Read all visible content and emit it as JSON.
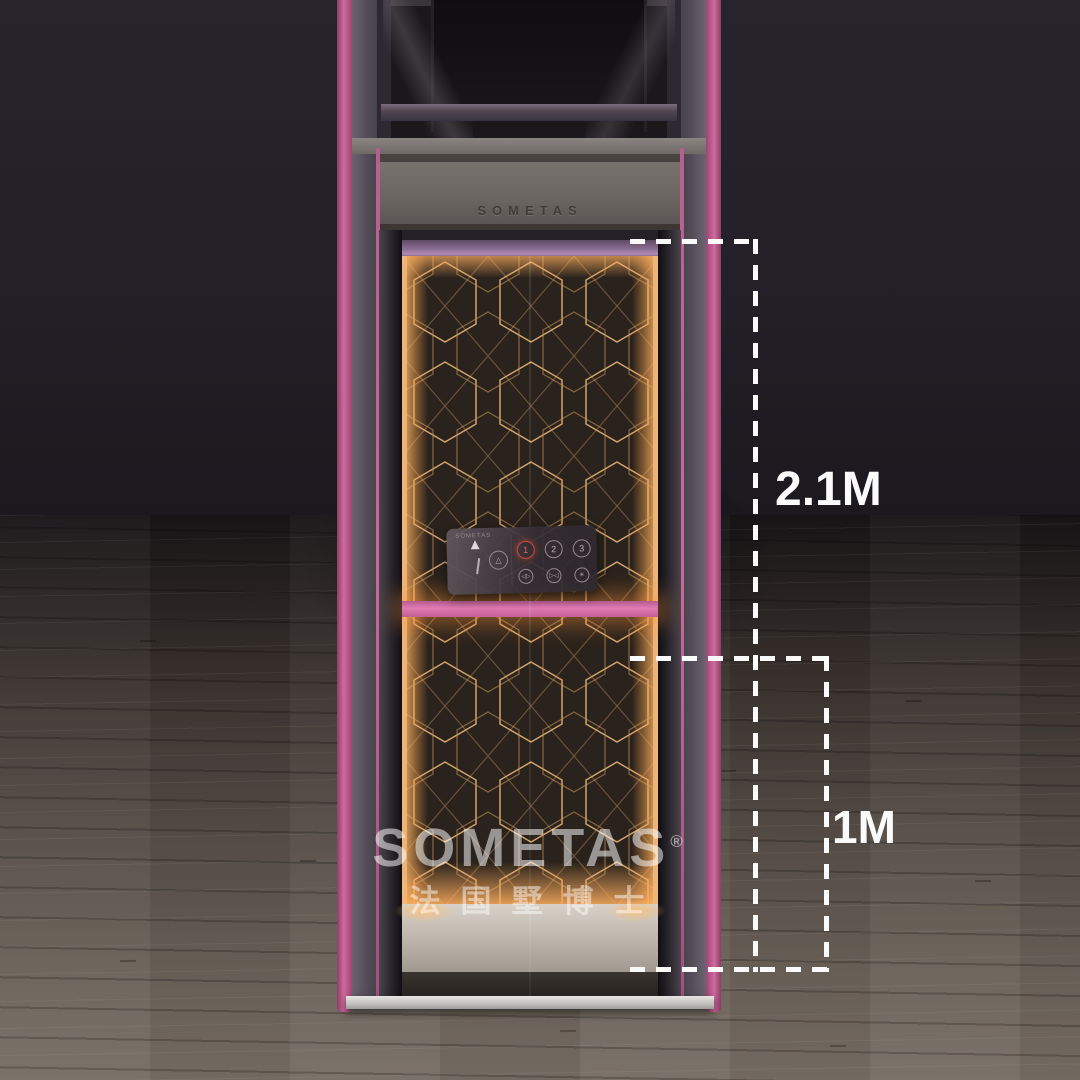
{
  "image": {
    "type": "product-render",
    "subject": "SOMETAS home villa elevator with dimension callouts"
  },
  "brand": {
    "name": "SOMETAS",
    "registered_mark": "®",
    "tagline_cn": "法国墅博士"
  },
  "header_plate": {
    "text": "SOMETAS"
  },
  "control_panel": {
    "logo": "SOMETAS",
    "direction_arrow": "▲",
    "alarm_icon": "△",
    "floor_buttons": [
      "1",
      "2",
      "3"
    ],
    "active_floor": "1",
    "door_open_icon": "◁▷",
    "door_close_icon": "▷◁",
    "aux_icon": "✳"
  },
  "dimensions": {
    "door_height": "2.1M",
    "rail_height": "1M"
  },
  "colors": {
    "accent_pink": "#cf6a9e",
    "handrail_pink": "#e07ab2",
    "pattern_gold": "#e0ad6b",
    "dimension_line": "#fafafa",
    "wall_dark": "#232127",
    "floor_wood": "#6a6158",
    "active_button_red": "#d24a40"
  }
}
